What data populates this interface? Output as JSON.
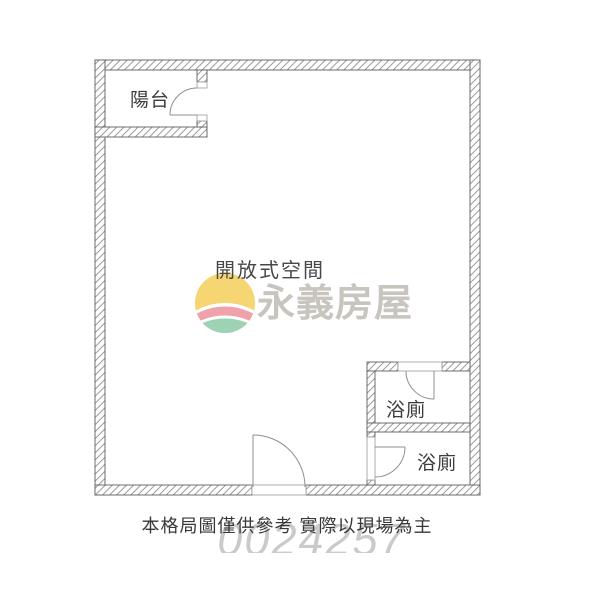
{
  "floor_plan": {
    "labels": {
      "balcony": "陽台",
      "open_space": "開放式空間",
      "bathroom_upper": "浴廁",
      "bathroom_lower": "浴廁"
    },
    "watermark": {
      "brand_name": "永義房屋",
      "serial_number": "0024257",
      "logo_colors": {
        "sun_yellow": "#F5D672",
        "band_pink": "#EFA2AA",
        "ground_green": "#9DD3B4"
      }
    },
    "disclaimer": "本格局圖僅供參考 實際以現場為主",
    "line_colors": {
      "wall_outline": "#5f5f5f",
      "wall_hatch": "#8f8f8f",
      "door_stroke": "#8f8f8f"
    }
  }
}
